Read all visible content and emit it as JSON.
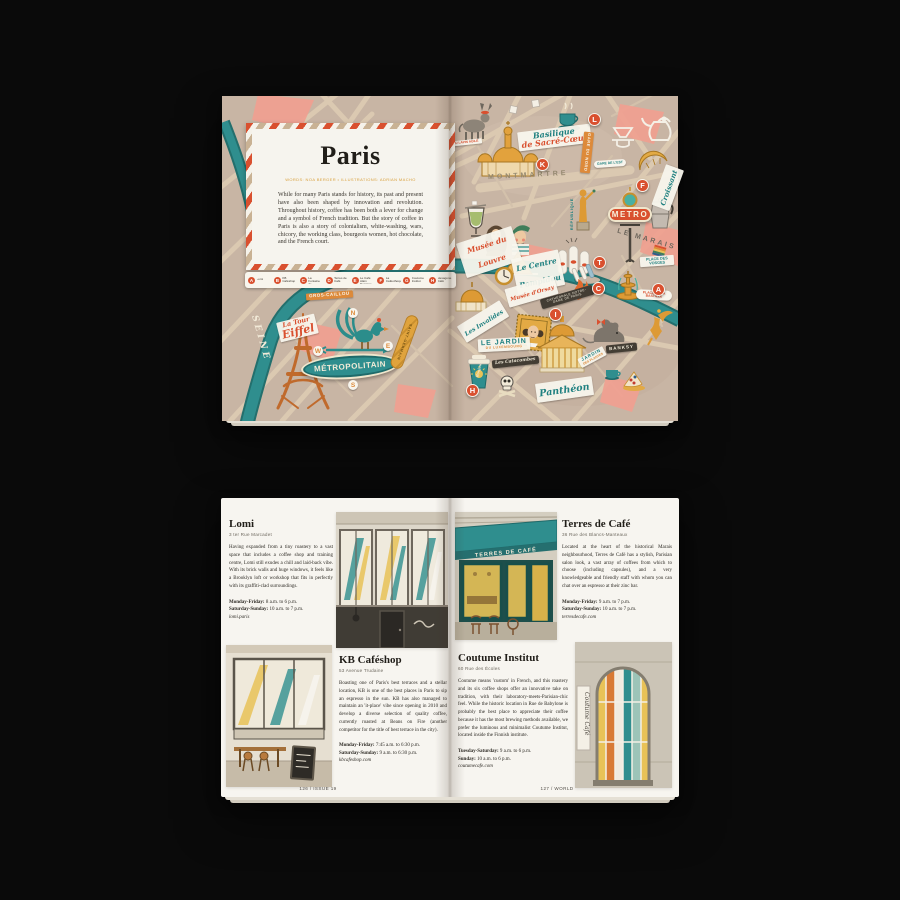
{
  "colors": {
    "red_accent": "#d9502f",
    "teal_accent": "#2f8e8e",
    "gold_accent": "#e0a33c",
    "map_base": "#c8b5a4",
    "pink_block": "#f0a090",
    "page": "#f7f5f0"
  },
  "top": {
    "card": {
      "title": "Paris",
      "byline": "WORDS: NOA BERGER • ILLUSTRATIONS: ADRIAN MACHO",
      "body": "While for many Paris stands for history, its past and present have also been shaped by innovation and revolution. Throughout history, coffee has been both a lever for change and a symbol of French tradition. But the story of coffee in Paris is also a story of colonialism, white-washing, wars, chicory, the working class, bourgeois women, hot chocolate, and the French court."
    },
    "legend": [
      {
        "letter": "A",
        "name": "Lomi"
      },
      {
        "letter": "B",
        "name": "KB Caféshop"
      },
      {
        "letter": "C",
        "name": "La Fontaine de Belleville"
      },
      {
        "letter": "D",
        "name": "Terres de Café"
      },
      {
        "letter": "E",
        "name": "Le Café Alain Ducasse"
      },
      {
        "letter": "F",
        "name": "La Caféothèque"
      },
      {
        "letter": "G",
        "name": "Coutume Institut"
      },
      {
        "letter": "H",
        "name": "Hexagone Café"
      }
    ],
    "badges": [
      "L",
      "K",
      "F",
      "T",
      "C",
      "I",
      "A",
      "H"
    ],
    "labels": {
      "seine": "SEINE",
      "gros_caillou": "GROS-CAILLOU",
      "tour_eiffel_1": "La Tour",
      "tour_eiffel_2": "Eiffel",
      "metropolitain": "MÉTROPOLITAIN",
      "saint_germain": "SAINT-GERMAIN",
      "compass_n": "N",
      "compass_e": "E",
      "compass_s": "S",
      "compass_w": "W",
      "lapin_agile": "AU LAPIN AGILE",
      "sacre_coeur_1": "Basilique",
      "sacre_coeur_2": "de Sacré-Cœur",
      "montmartre": "MONTMARTRE",
      "gare_du_nord": "GARE DU NORD",
      "gare_de_lest": "GARE DE L'EST",
      "republique": "RÉPUBLIQUE",
      "croissant": "Croissant",
      "metro": "METRO",
      "le_marais": "LE MARAIS",
      "musee_louvre": "Musée du Louvre",
      "centre_pompidou": "Le Centre Pompidou",
      "place_des_vosges": "PLACE DES VOSGES",
      "notre_dame": "CATHÉDRALE NOTRE-DAME DE PARIS",
      "bastille": "PLACE DE LA BASTILLE",
      "musee_orsay": "Musée d'Orsay",
      "invalides": "Les Invalides",
      "jardin_lux_1": "LE JARDIN",
      "jardin_lux_2": "DU LUXEMBOURG",
      "pantheon": "Panthéon",
      "banksy": "BANKSY",
      "jardin_plantes_1": "JARDIN",
      "jardin_plantes_2": "DES PLANTES",
      "catacombes": "Les Catacombes",
      "bonjour": "Bonjour"
    }
  },
  "bottom": {
    "entries": [
      {
        "name": "Lomi",
        "address": "3 ter Rue Marcadet",
        "body": "Having expanded from a tiny roastery to a vast space that includes a coffee shop and training centre, Lomi still exudes a chill and laid-back vibe. With its brick walls and huge windows, it feels like a Brooklyn loft or workshop that fits in perfectly with its graffiti-clad surroundings.",
        "hours": [
          {
            "label": "Monday-Friday:",
            "value": "8 a.m. to 6 p.m."
          },
          {
            "label": "Saturday-Sunday:",
            "value": "10 a.m. to 7 p.m."
          }
        ],
        "website": "lomi.paris"
      },
      {
        "name": "KB Caféshop",
        "address": "53 Avenue Trudaine",
        "body": "Boasting one of Paris's best terraces and a stellar location, KB is one of the best places in Paris to sip an espresso in the sun. KB has also managed to maintain an 'it-place' vibe since opening in 2010 and develop a diverse selection of quality coffee, currently roasted at Beans on Fire (another competitor for the title of best terrace in the city).",
        "hours": [
          {
            "label": "Monday-Friday:",
            "value": "7:45 a.m. to 6:30 p.m."
          },
          {
            "label": "Saturday-Sunday:",
            "value": "9 a.m. to 6:30 p.m."
          }
        ],
        "website": "kbcafeshop.com"
      },
      {
        "name": "Terres de Café",
        "address": "36 Rue des Blancs-Manteaux",
        "body": "Located at the heart of the historical Marais neighbourhood, Terres de Café has a stylish, Parisian salon look, a vast array of coffees from which to choose (including capsules), and a very knowledgeable and friendly staff with whom you can chat over an espresso at their zinc bar.",
        "hours": [
          {
            "label": "Monday-Friday:",
            "value": "9 a.m. to 7 p.m."
          },
          {
            "label": "Saturday-Sunday:",
            "value": "10 a.m. to 7 p.m."
          }
        ],
        "website": "terresdecafe.com"
      },
      {
        "name": "Coutume Institut",
        "address": "60 Rue des Écoles",
        "body": "Coutume means 'custom' in French, and this roastery and its six coffee shops offer an innovative take on tradition, with their laboratory-meets-Parisian-chic feel. While the historic location in Rue de Babylone is probably the best place to appreciate their coffee because it has the most brewing methods available, we prefer the luminous and minimalist Coutume Institut, located inside the Finnish institute.",
        "hours": [
          {
            "label": "Tuesday-Saturday:",
            "value": "9 a.m. to 6 p.m."
          },
          {
            "label": "Sunday:",
            "value": "10 a.m. to 6 p.m."
          }
        ],
        "website": "coutumecafe.com"
      }
    ],
    "terres_awning": "TERRES DE CAFÉ",
    "coutume_sign": "Coutume Café",
    "footer_left": "126 / ISSUE 19",
    "footer_right": "127 / WORLD"
  }
}
